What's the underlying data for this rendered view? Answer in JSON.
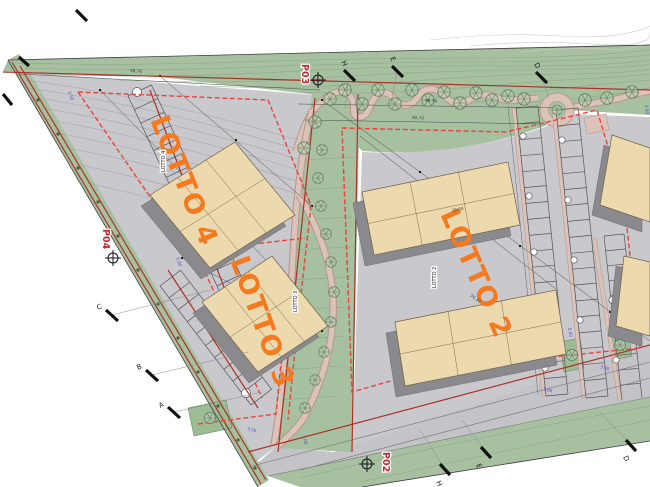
{
  "lots": {
    "lotto2": "LOTTO 2",
    "lotto3": "LOTTO 3",
    "lotto4": "LOTTO 4",
    "lotto2_small": "LOTTO 2",
    "lotto3_small": "LOTTO 3",
    "lotto4_small": "LOTTO 4"
  },
  "survey_points": {
    "p02": "P02",
    "p03": "P03",
    "p04": "P04"
  },
  "section_markers": {
    "top_h": "H",
    "top_e": "E",
    "top_d": "D",
    "bottom_h": "H",
    "bottom_e": "E",
    "bottom_d": "D",
    "left_a": "A",
    "left_b": "B",
    "left_c": "C"
  },
  "dimensions": {
    "top_main": "98.76",
    "top_secondary": "90.70",
    "boundary": "98.76",
    "building_a": "28.00",
    "building_b": "50.30"
  },
  "blue_dims": {
    "v1": "5.00",
    "v2": "2.50",
    "v3": "3.50",
    "v4": "7.00",
    "v5": "5.00",
    "v6": "2.50",
    "v7": "5.00",
    "v8": "3.50"
  },
  "colors": {
    "green_area": "#a6c0a0",
    "pavement": "#c9c9cd",
    "building_fill": "#ecd9ae",
    "building_shadow": "#8a8a8e",
    "boundary_red": "#a93226",
    "lot_dashed_red": "#e8433a",
    "lot_text_orange": "#f5791e",
    "path_pink": "#dcc3b9",
    "dimension_blue": "#4747d1"
  }
}
